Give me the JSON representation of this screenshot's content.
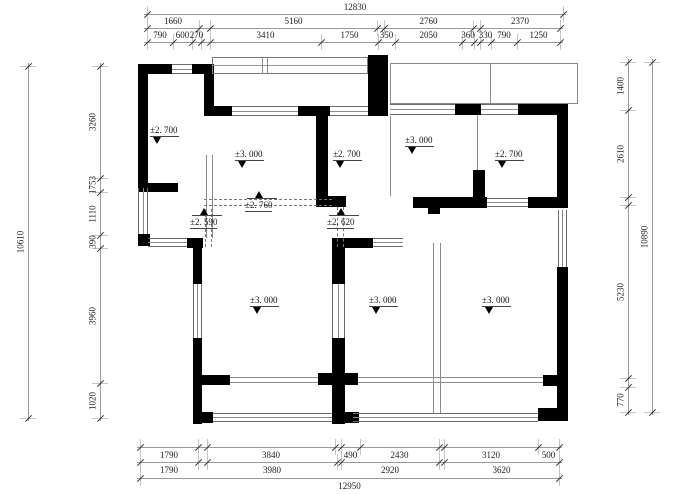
{
  "drawing": {
    "type": "architectural-floor-plan",
    "wall_color": "#000000",
    "line_color": "#8a8a8a",
    "background": "#ffffff"
  },
  "dimensions": [
    {
      "id": "top-overall",
      "orient": "h",
      "pos": 14,
      "text_side": "above",
      "segments": [
        {
          "label": "12830",
          "from": 147,
          "to": 563
        }
      ]
    },
    {
      "id": "top-groups",
      "orient": "h",
      "pos": 28,
      "text_side": "above",
      "segments": [
        {
          "label": "1660",
          "from": 147,
          "to": 199
        },
        {
          "label": "",
          "from": 199,
          "to": 210
        },
        {
          "label": "5160",
          "from": 210,
          "to": 377
        },
        {
          "label": "",
          "from": 377,
          "to": 384
        },
        {
          "label": "2760",
          "from": 384,
          "to": 473
        },
        {
          "label": "",
          "from": 473,
          "to": 480
        },
        {
          "label": "2370",
          "from": 480,
          "to": 560
        }
      ]
    },
    {
      "id": "top-detail",
      "orient": "h",
      "pos": 42,
      "text_side": "above",
      "segments": [
        {
          "label": "790",
          "from": 147,
          "to": 173
        },
        {
          "label": "600",
          "from": 173,
          "to": 192
        },
        {
          "label": "270",
          "from": 192,
          "to": 201
        },
        {
          "label": "",
          "from": 201,
          "to": 210
        },
        {
          "label": "3410",
          "from": 210,
          "to": 321
        },
        {
          "label": "1750",
          "from": 321,
          "to": 378
        },
        {
          "label": "350",
          "from": 378,
          "to": 395
        },
        {
          "label": "2050",
          "from": 395,
          "to": 462
        },
        {
          "label": "360",
          "from": 462,
          "to": 474
        },
        {
          "label": "",
          "from": 474,
          "to": 480
        },
        {
          "label": "330",
          "from": 480,
          "to": 491
        },
        {
          "label": "790",
          "from": 491,
          "to": 517
        },
        {
          "label": "1250",
          "from": 517,
          "to": 560
        }
      ]
    },
    {
      "id": "left-outer",
      "orient": "v",
      "pos": 28,
      "text_side": "left",
      "segments": [
        {
          "label": "10610",
          "from": 66,
          "to": 418
        }
      ]
    },
    {
      "id": "left-inner",
      "orient": "v",
      "pos": 100,
      "text_side": "left",
      "segments": [
        {
          "label": "3260",
          "from": 66,
          "to": 178
        },
        {
          "label": "1753",
          "from": 178,
          "to": 192
        },
        {
          "label": "1110",
          "from": 192,
          "to": 235
        },
        {
          "label": "390",
          "from": 235,
          "to": 248
        },
        {
          "label": "3960",
          "from": 248,
          "to": 383
        },
        {
          "label": "1020",
          "from": 383,
          "to": 418
        }
      ]
    },
    {
      "id": "right-inner",
      "orient": "v",
      "pos": 628,
      "text_side": "left",
      "segments": [
        {
          "label": "1400",
          "from": 62,
          "to": 110
        },
        {
          "label": "2610",
          "from": 110,
          "to": 197
        },
        {
          "label": "",
          "from": 197,
          "to": 205
        },
        {
          "label": "5230",
          "from": 205,
          "to": 378
        },
        {
          "label": "",
          "from": 378,
          "to": 387
        },
        {
          "label": "770",
          "from": 387,
          "to": 412
        }
      ]
    },
    {
      "id": "right-outer",
      "orient": "v",
      "pos": 652,
      "text_side": "left",
      "segments": [
        {
          "label": "10890",
          "from": 62,
          "to": 412
        }
      ]
    },
    {
      "id": "bottom-detail",
      "orient": "h",
      "pos": 447,
      "text_side": "below",
      "segments": [
        {
          "label": "1790",
          "from": 140,
          "to": 198
        },
        {
          "label": "",
          "from": 198,
          "to": 207
        },
        {
          "label": "3840",
          "from": 207,
          "to": 335
        },
        {
          "label": "",
          "from": 335,
          "to": 341
        },
        {
          "label": "490",
          "from": 341,
          "to": 360
        },
        {
          "label": "2430",
          "from": 360,
          "to": 439
        },
        {
          "label": "",
          "from": 439,
          "to": 444
        },
        {
          "label": "3120",
          "from": 444,
          "to": 538
        },
        {
          "label": "500",
          "from": 538,
          "to": 559
        }
      ]
    },
    {
      "id": "bottom-groups",
      "orient": "h",
      "pos": 462,
      "text_side": "below",
      "segments": [
        {
          "label": "1790",
          "from": 140,
          "to": 198
        },
        {
          "label": "",
          "from": 198,
          "to": 207
        },
        {
          "label": "3980",
          "from": 207,
          "to": 337
        },
        {
          "label": "",
          "from": 337,
          "to": 341
        },
        {
          "label": "2920",
          "from": 341,
          "to": 439
        },
        {
          "label": "",
          "from": 439,
          "to": 444
        },
        {
          "label": "3620",
          "from": 444,
          "to": 559
        }
      ]
    },
    {
      "id": "bottom-overall",
      "orient": "h",
      "pos": 478,
      "text_side": "below",
      "segments": [
        {
          "label": "12950",
          "from": 140,
          "to": 559
        }
      ]
    }
  ],
  "levels": [
    {
      "label": "±2. 700",
      "type": "down",
      "x": 150,
      "y": 126
    },
    {
      "label": "±3. 000",
      "type": "down",
      "x": 235,
      "y": 150
    },
    {
      "label": "±2. 700",
      "type": "down",
      "x": 333,
      "y": 150
    },
    {
      "label": "±3. 000",
      "type": "down",
      "x": 405,
      "y": 136
    },
    {
      "label": "±2. 700",
      "type": "down",
      "x": 495,
      "y": 150
    },
    {
      "label": "±2. 760",
      "type": "up",
      "x": 245,
      "y": 191
    },
    {
      "label": "±2. 590",
      "type": "up",
      "x": 190,
      "y": 208
    },
    {
      "label": "±2. 620",
      "type": "up",
      "x": 327,
      "y": 208
    },
    {
      "label": "±3. 000",
      "type": "down",
      "x": 250,
      "y": 296
    },
    {
      "label": "±3. 000",
      "type": "down",
      "x": 369,
      "y": 296
    },
    {
      "label": "±3. 000",
      "type": "down",
      "x": 482,
      "y": 296
    }
  ]
}
